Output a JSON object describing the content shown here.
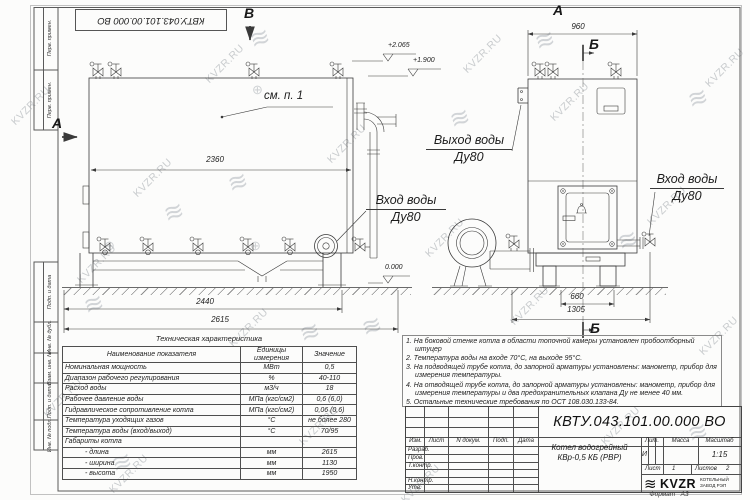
{
  "drawing": {
    "stamp": "КВТУ.043.101.00.000 ВО",
    "margin_labels": [
      "Перв. примен.",
      "Перв. примен.",
      "Подп. и дата",
      "Инв. № дубл.",
      "Взам. инв. №",
      "Подп. и дата",
      "Инв. № подл."
    ],
    "letters": {
      "a_left": "А",
      "v_top": "В",
      "a_top": "А",
      "b_top": "Б",
      "b_bottom": "Б"
    },
    "see_note": "см. п. 1",
    "dims": {
      "body_len": "2360",
      "base_len": "2440",
      "total_len": "2615",
      "top_width": "960",
      "offset_small": "660",
      "offset_big": "1305"
    },
    "elev": {
      "valve_top": "+2.065",
      "outlet": "+1.900",
      "ground": "0.000"
    },
    "callouts": {
      "outlet": {
        "l1": "Выход воды",
        "l2": "Ду80"
      },
      "inlet_front": {
        "l1": "Вход воды",
        "l2": "Ду80"
      },
      "inlet_side": {
        "l1": "Вход воды",
        "l2": "Ду80"
      }
    }
  },
  "wm": {
    "text": "KVZR.RU",
    "logo": "≋",
    "reg": "⊕"
  },
  "spec_table": {
    "title": "Техническая характеристика",
    "headers": [
      "Наименование показателя",
      "Единицы измерения",
      "Значение"
    ],
    "rows": [
      [
        "Номинальная мощность",
        "МВт",
        "0,5"
      ],
      [
        "Диапазон рабочего регулирования",
        "%",
        "40-110"
      ],
      [
        "Расход воды",
        "м3/ч",
        "18"
      ],
      [
        "Рабочее давление воды",
        "МПа (кгс/см2)",
        "0,6 (6,0)"
      ],
      [
        "Гидравлическое сопротивление котла",
        "МПа (кгс/см2)",
        "0,06 (0,6)"
      ],
      [
        "Температура уходящих газов",
        "°С",
        "не более 280"
      ],
      [
        "Температура воды (вход/выход)",
        "°С",
        "70/95"
      ],
      [
        "Габариты котла",
        "",
        ""
      ],
      [
        "- длина",
        "мм",
        "2615"
      ],
      [
        "- ширина",
        "мм",
        "1130"
      ],
      [
        "- высота",
        "мм",
        "1950"
      ]
    ]
  },
  "notes": {
    "items": [
      "1. На боковой стенке котла в области топочной камеры установлен пробоотборный штуцер",
      "2. Температура воды на входе 70°С, на выходе 95°С.",
      "3. На подводящей трубе котла, до запорной арматуры установлены: манометр, прибор для измерения температуры.",
      "4. На отводящей трубе котла, до запорной арматуры установлены: манометр, прибор для измерения температуры и два предохранительных клапана Ду не менее 40 мм.",
      "5. Остальные технические требования по ОСТ 108.030.133-84."
    ]
  },
  "title_block": {
    "doc_number": "КВТУ.043.101.00.000 ВО",
    "product_l1": "Котел водогрейный",
    "product_l2": "КВр-0,5 КБ (РВР)",
    "col_izm": "Изм.",
    "col_list": "Лист",
    "col_ndoc": "N докум.",
    "col_podp": "Подп.",
    "col_data": "Дата",
    "row_razrab": "Разраб.",
    "row_prov": "Пров.",
    "row_tkontr": "Т.контр.",
    "row_nkontr": "Н.контр.",
    "row_utv": "Утв.",
    "lit_label": "Лит.",
    "lit_value": "И",
    "massa_label": "Масса",
    "scale_label": "Масштаб",
    "scale_value": "1:15",
    "sheet_label": "Лист",
    "sheet_value": "1",
    "sheets_label": "Листов",
    "sheets_value": "2",
    "logo_text": "KVZR",
    "logo_sub1": "КОТЕЛЬНЫЙ",
    "logo_sub2": "ЗАВОД РЭП",
    "format_label": "Формат",
    "format_value": "А3"
  }
}
